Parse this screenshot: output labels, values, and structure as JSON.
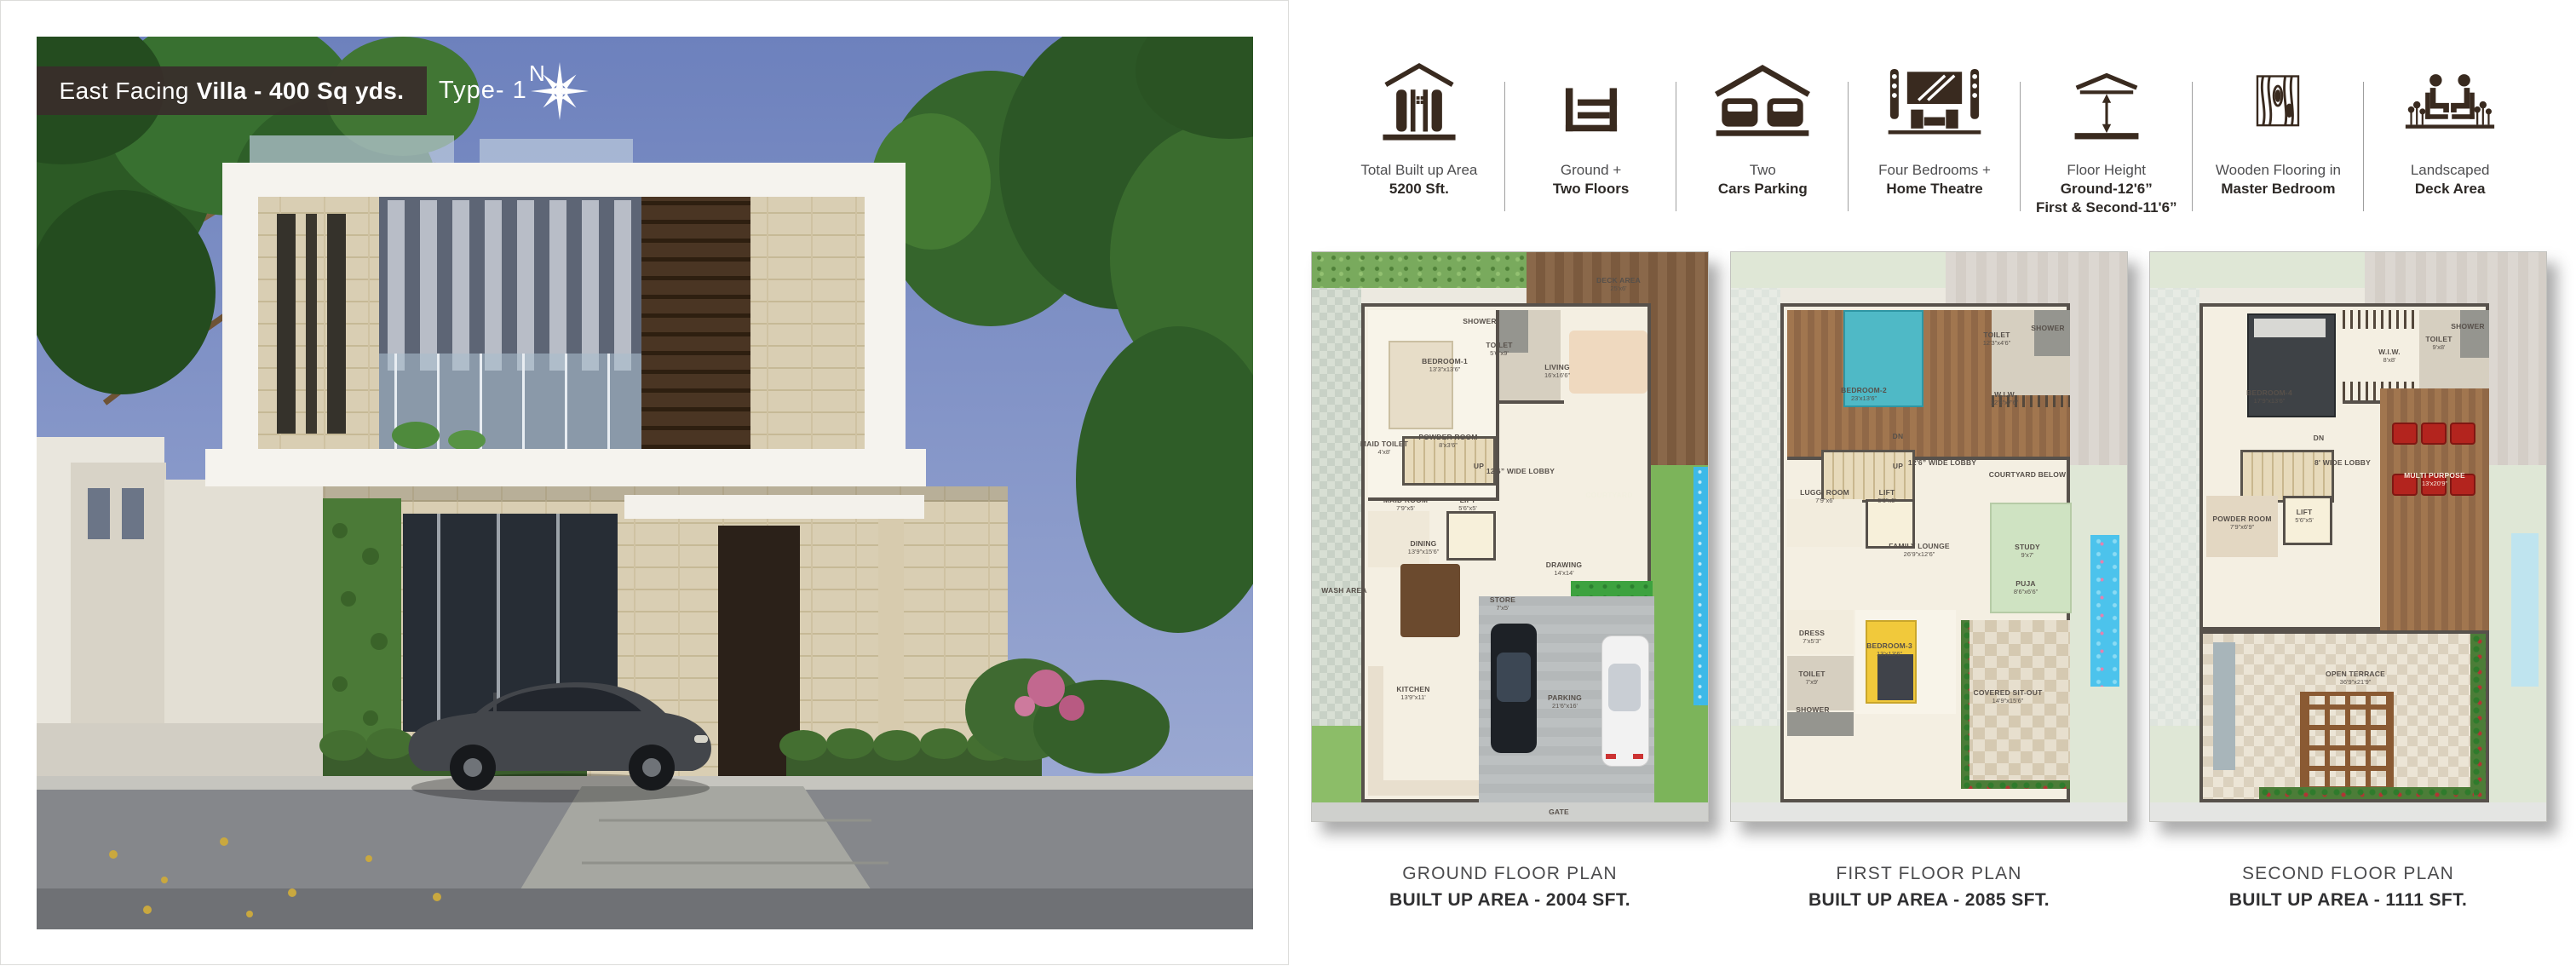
{
  "colors": {
    "icon_brown": "#392a1f",
    "badge_bg": "#382e2a",
    "caption_gray": "#4b4b4d"
  },
  "photo": {
    "badge_prefix": "East Facing",
    "badge_bold": "Villa - 400 Sq yds.",
    "type_label": "Type- 1",
    "compass_label": "N"
  },
  "features": [
    {
      "icon": "built-up-area-icon",
      "line1": "Total Built up Area",
      "line2": "5200 Sft."
    },
    {
      "icon": "floors-icon",
      "line1": "Ground +",
      "line2": "Two Floors"
    },
    {
      "icon": "cars-parking-icon",
      "line1": "Two",
      "line2": "Cars Parking"
    },
    {
      "icon": "home-theatre-icon",
      "line1": "Four Bedrooms +",
      "line2": "Home Theatre"
    },
    {
      "icon": "floor-height-icon",
      "line1": "Floor Height",
      "line2": "Ground-12'6”",
      "line3": "First & Second-11'6”"
    },
    {
      "icon": "wooden-flooring-icon",
      "line1": "Wooden Flooring in",
      "line2": "Master Bedroom"
    },
    {
      "icon": "deck-area-icon",
      "line1": "Landscaped",
      "line2": "Deck Area"
    }
  ],
  "plans": [
    {
      "title": "GROUND FLOOR PLAN",
      "area": "BUILT UP AREA - 2004 SFT.",
      "rooms": [
        {
          "name": "DECK AREA",
          "dims": "25'x6'"
        },
        {
          "name": "BEDROOM-1",
          "dims": "13'3”x13'6”"
        },
        {
          "name": "SHOWER",
          "dims": ""
        },
        {
          "name": "TOILET",
          "dims": "5'6”x9'"
        },
        {
          "name": "LIVING",
          "dims": "16'x16'6”"
        },
        {
          "name": "MAID TOILET",
          "dims": "4'x8'"
        },
        {
          "name": "POWDER ROOM",
          "dims": "8'x3'6”"
        },
        {
          "name": "UP",
          "dims": ""
        },
        {
          "name": "12'6” WIDE LOBBY",
          "dims": ""
        },
        {
          "name": "COURTYARD",
          "dims": ""
        },
        {
          "name": "MAID ROOM",
          "dims": "7'9”x5'"
        },
        {
          "name": "LIFT",
          "dims": "5'6”x5'"
        },
        {
          "name": "DINING",
          "dims": "13'9”x15'6”"
        },
        {
          "name": "WASH AREA",
          "dims": ""
        },
        {
          "name": "STORE",
          "dims": "7'x5'"
        },
        {
          "name": "DRAWING",
          "dims": "14'x14'"
        },
        {
          "name": "KITCHEN",
          "dims": "13'9”x11'"
        },
        {
          "name": "PARKING",
          "dims": "21'6”x16'"
        },
        {
          "name": "GATE",
          "dims": ""
        }
      ]
    },
    {
      "title": "FIRST FLOOR PLAN",
      "area": "BUILT UP AREA - 2085 SFT.",
      "rooms": [
        {
          "name": "BEDROOM-2",
          "dims": "23'x13'6”"
        },
        {
          "name": "TOILET",
          "dims": "12'3”x4'6”"
        },
        {
          "name": "SHOWER",
          "dims": ""
        },
        {
          "name": "W.I.W",
          "dims": "12'3”x7'6”"
        },
        {
          "name": "DN",
          "dims": ""
        },
        {
          "name": "UP",
          "dims": ""
        },
        {
          "name": "12'6” WIDE LOBBY",
          "dims": ""
        },
        {
          "name": "COURTYARD BELOW",
          "dims": ""
        },
        {
          "name": "LUGG. ROOM",
          "dims": "7'9”x6'"
        },
        {
          "name": "LIFT",
          "dims": "5'6”x5'"
        },
        {
          "name": "FAMILY LOUNGE",
          "dims": "26'9”x12'6”"
        },
        {
          "name": "STUDY",
          "dims": "9'x7'"
        },
        {
          "name": "PUJA",
          "dims": "8'6”x6'6”"
        },
        {
          "name": "DRESS",
          "dims": "7'x5'3”"
        },
        {
          "name": "BEDROOM-3",
          "dims": "13'x13'6”"
        },
        {
          "name": "TOILET",
          "dims": "7'x9'"
        },
        {
          "name": "SHOWER",
          "dims": ""
        },
        {
          "name": "COVERED SIT-OUT",
          "dims": "14'9”x15'6”"
        }
      ]
    },
    {
      "title": "SECOND FLOOR PLAN",
      "area": "BUILT UP AREA - 1111 SFT.",
      "rooms": [
        {
          "name": "BEDROOM-4",
          "dims": "17'9”x13'6”"
        },
        {
          "name": "W.I.W.",
          "dims": "8'x8'"
        },
        {
          "name": "TOILET",
          "dims": "9'x8'"
        },
        {
          "name": "SHOWER",
          "dims": ""
        },
        {
          "name": "DN",
          "dims": ""
        },
        {
          "name": "8' WIDE LOBBY",
          "dims": ""
        },
        {
          "name": "POWDER ROOM",
          "dims": "7'9”x6'9”"
        },
        {
          "name": "LIFT",
          "dims": "5'6”x5'"
        },
        {
          "name": "MULTI PURPOSE",
          "dims": "13'x20'9”"
        },
        {
          "name": "OPEN TERRACE",
          "dims": "36'9”x21'9”"
        }
      ]
    }
  ]
}
